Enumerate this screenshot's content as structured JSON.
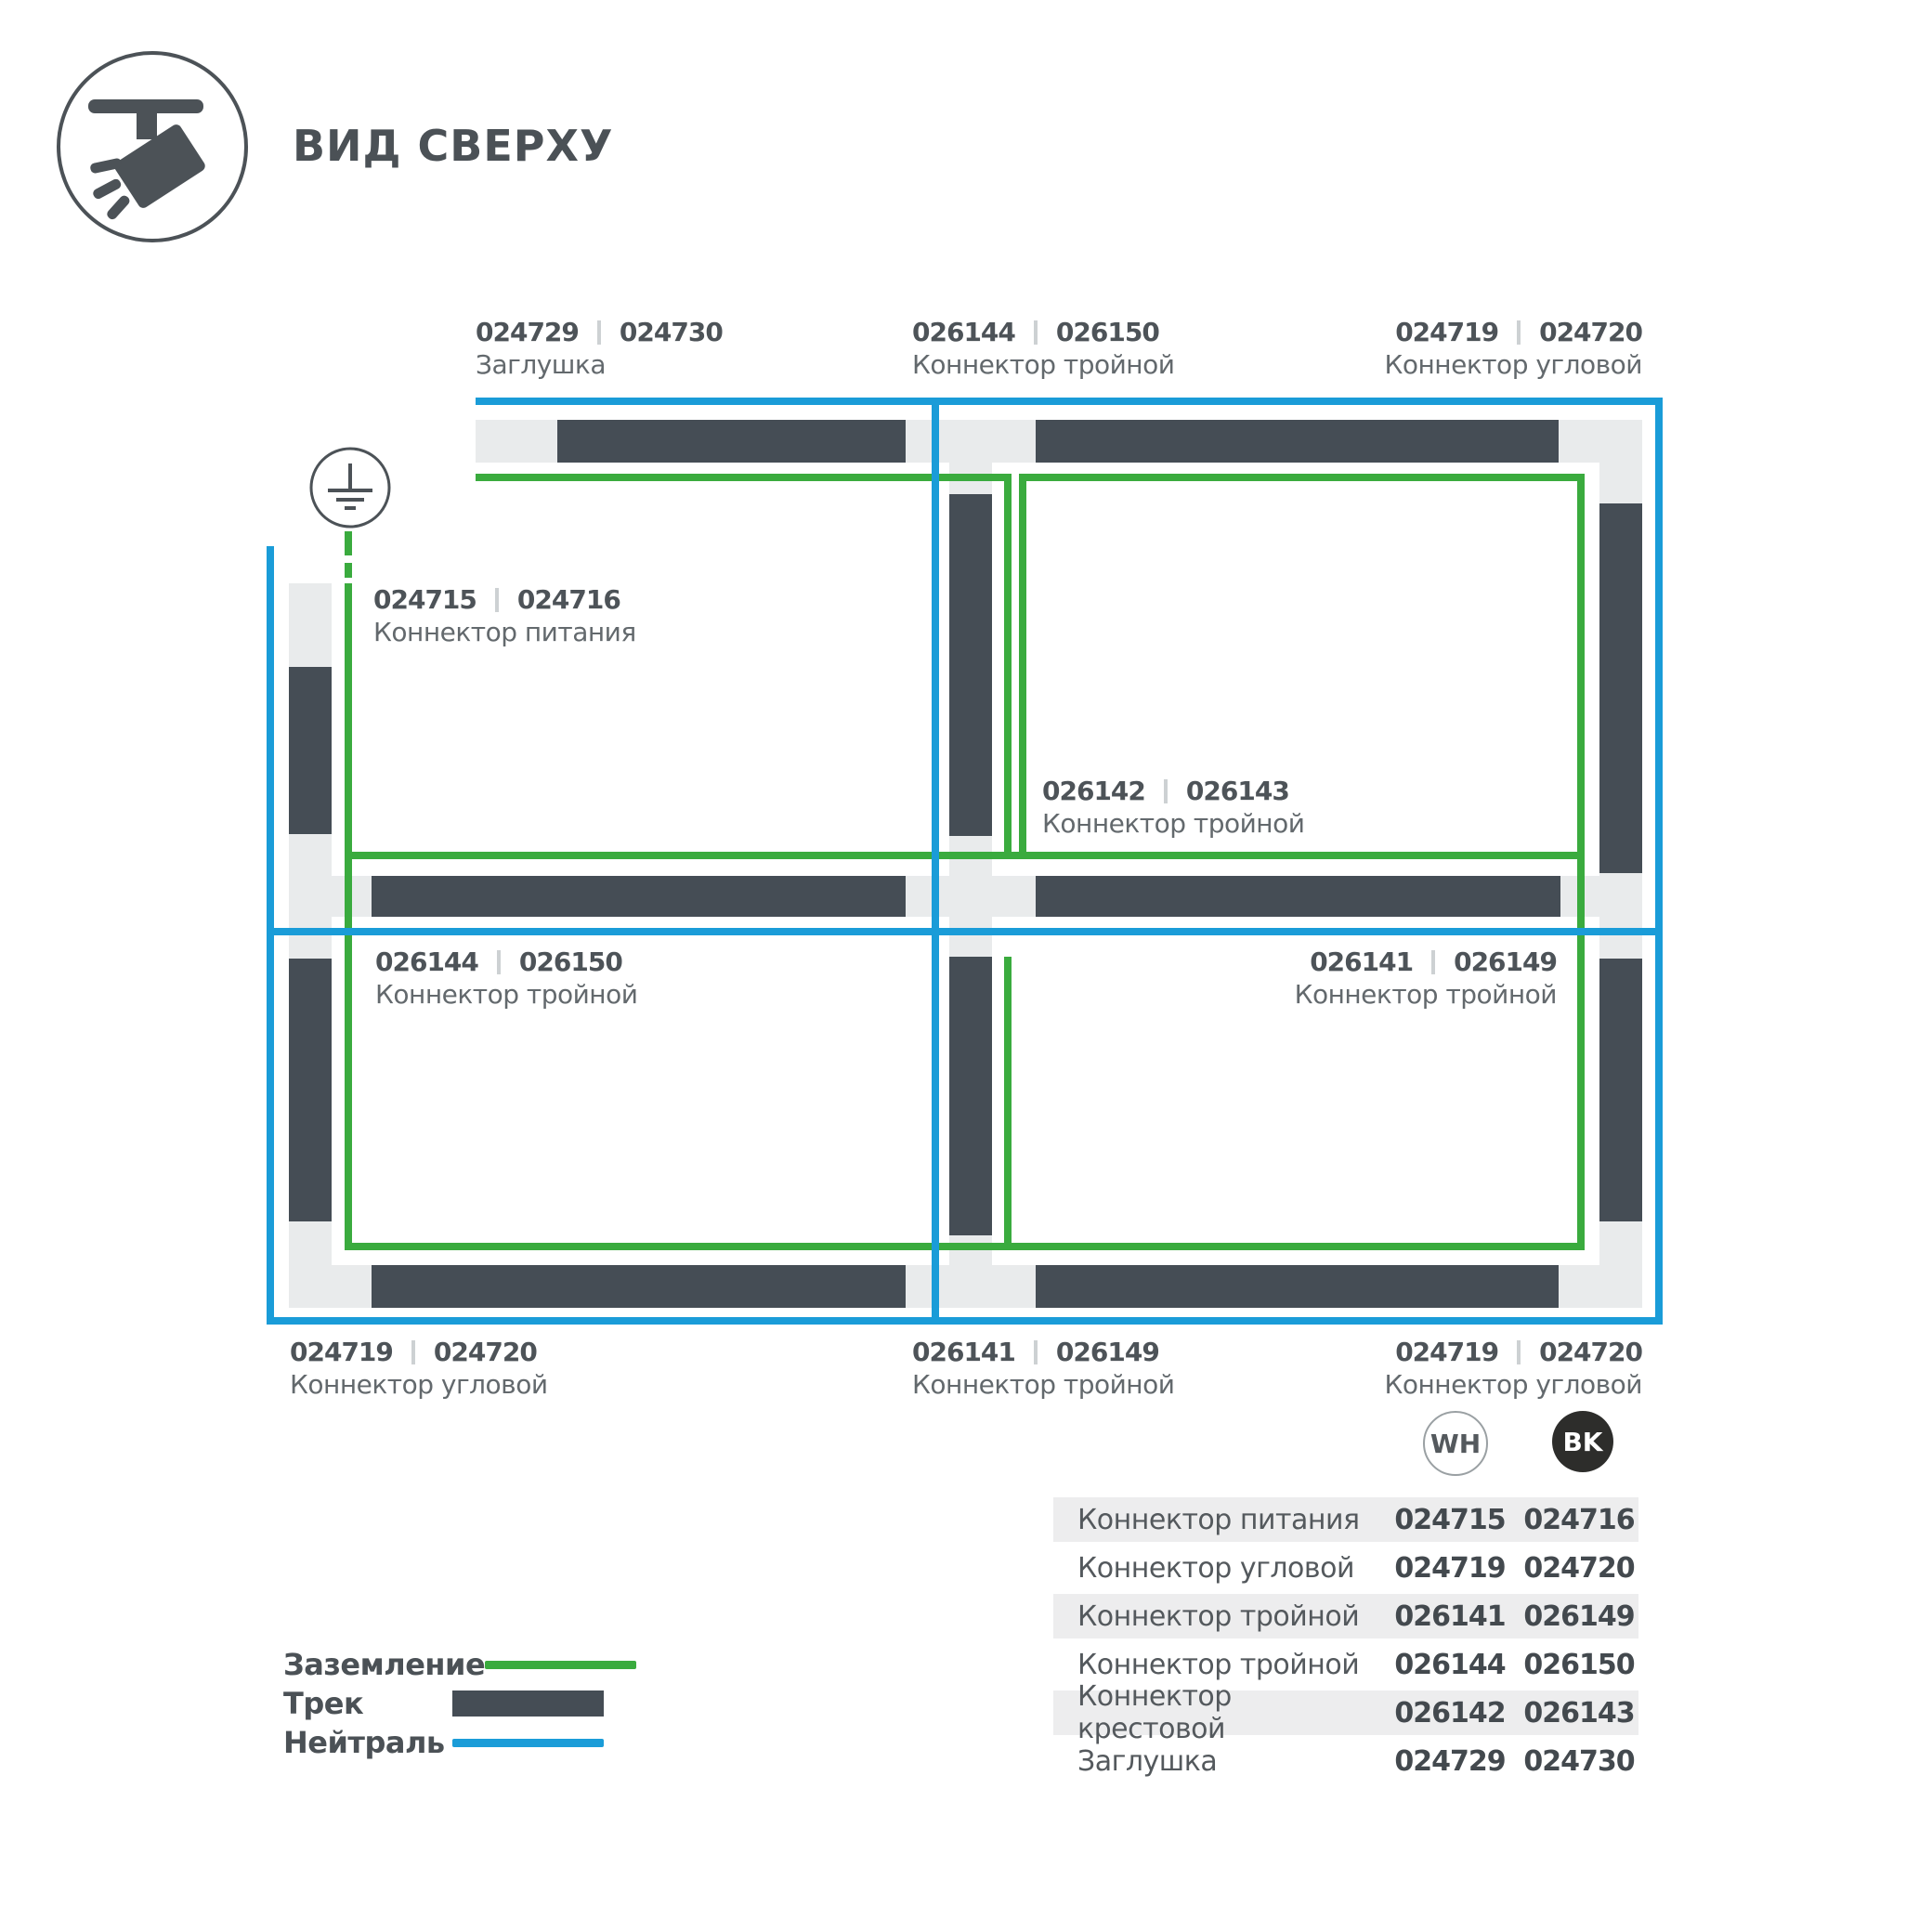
{
  "header": {
    "title": "ВИД СВЕРХУ"
  },
  "colors": {
    "ground_green": "#3aab3e",
    "neutral_blue": "#1a9cd8",
    "track_dark": "#454d55",
    "connector_light": "#e9ebec",
    "bk_badge": "#2d2d2b"
  },
  "diagram": {
    "labels": [
      {
        "num_wh": "024729",
        "num_bk": "024730",
        "name": "Заглушка"
      },
      {
        "num_wh": "026144",
        "num_bk": "026150",
        "name": "Коннектор тройной"
      },
      {
        "num_wh": "024719",
        "num_bk": "024720",
        "name": "Коннектор угловой"
      },
      {
        "num_wh": "024715",
        "num_bk": "024716",
        "name": "Коннектор питания"
      },
      {
        "num_wh": "026142",
        "num_bk": "026143",
        "name": "Коннектор тройной"
      },
      {
        "num_wh": "026144",
        "num_bk": "026150",
        "name": "Коннектор тройной"
      },
      {
        "num_wh": "026141",
        "num_bk": "026149",
        "name": "Коннектор тройной"
      },
      {
        "num_wh": "024719",
        "num_bk": "024720",
        "name": "Коннектор угловой"
      },
      {
        "num_wh": "026141",
        "num_bk": "026149",
        "name": "Коннектор тройной"
      },
      {
        "num_wh": "024719",
        "num_bk": "024720",
        "name": "Коннектор угловой"
      }
    ]
  },
  "legend": {
    "items": [
      {
        "label": "Заземление",
        "type": "ground-line"
      },
      {
        "label": "Трек",
        "type": "track-bar"
      },
      {
        "label": "Нейтраль",
        "type": "neutral-line"
      }
    ]
  },
  "table": {
    "columns": [
      {
        "label": "WH"
      },
      {
        "label": "BK"
      }
    ],
    "rows": [
      {
        "name": "Коннектор питания",
        "wh": "024715",
        "bk": "024716"
      },
      {
        "name": "Коннектор угловой",
        "wh": "024719",
        "bk": "024720"
      },
      {
        "name": "Коннектор тройной",
        "wh": "026141",
        "bk": "026149"
      },
      {
        "name": "Коннектор тройной",
        "wh": "026144",
        "bk": "026150"
      },
      {
        "name": "Коннектор крестовой",
        "wh": "026142",
        "bk": "026143"
      },
      {
        "name": "Заглушка",
        "wh": "024729",
        "bk": "024730"
      }
    ]
  }
}
